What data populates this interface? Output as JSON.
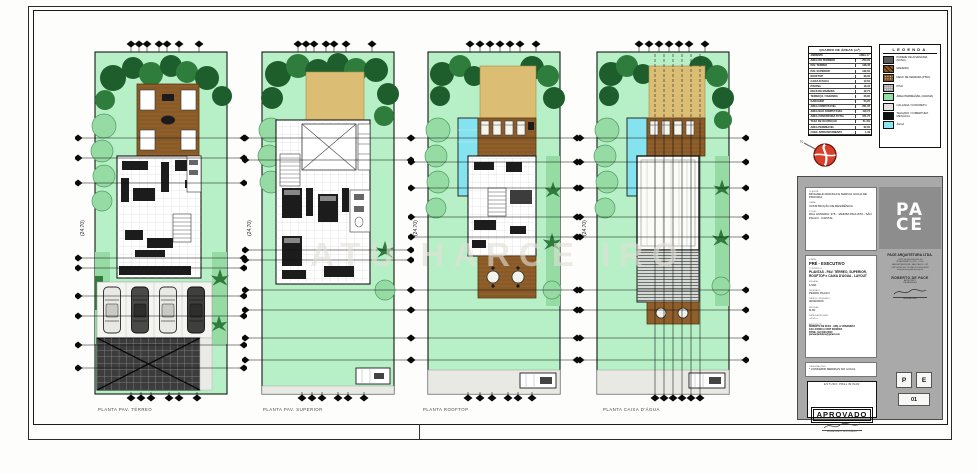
{
  "sheet": {
    "watermark": "ATU HARCE IRO"
  },
  "colors": {
    "grass": "#b7f0c6",
    "tree_dark": "#1d5e2c",
    "tree_mid": "#2f7d3c",
    "deck_wood": "#8f5e2a",
    "sand": "#dcbd74",
    "water": "#84e3ef",
    "asphalt": "#3c3c3c",
    "panel_gray": "#a9a9a9",
    "north_red": "#d8402c"
  },
  "plans": [
    {
      "caption": "PLANTA PAV. TÉRREO",
      "dim_note": "(24.70)"
    },
    {
      "caption": "PLANTA PAV. SUPERIOR",
      "dim_note": "(24.70)"
    },
    {
      "caption": "PLANTA ROOFTOP",
      "dim_note": "(24.70)"
    },
    {
      "caption": "PLANTA CAIXA D'ÁGUA",
      "dim_note": "(24.70)"
    }
  ],
  "areas_table": {
    "title": "QUADRO DE ÁREAS (m²)",
    "col_label": "AMBIENTE",
    "col_value": "ÁREA m²",
    "rows": [
      {
        "label": "ÁREA DO TERRENO",
        "value": "250,00"
      },
      {
        "label": "PAV. TÉRREO",
        "value": "128,45"
      },
      {
        "label": "PAV. SUPERIOR",
        "value": "132,60"
      },
      {
        "label": "ROOFTOP",
        "value": "98,30"
      },
      {
        "label": "CAIXA D'ÁGUA",
        "value": "12,50"
      },
      {
        "label": "PISCINA",
        "value": "18,40"
      },
      {
        "label": "DECK DE MADEIRA",
        "value": "42,75"
      },
      {
        "label": "TERRAÇO / VARANDA",
        "value": "26,80"
      },
      {
        "label": "GARAGEM",
        "value": "54,20"
      },
      {
        "label": "ÁREA COMPUTÁVEL",
        "value": "261,05"
      },
      {
        "label": "ÁREA NÃO COMPUTÁVEL",
        "value": "110,70"
      },
      {
        "label": "ÁREA CONSTRUÍDA TOTAL",
        "value": "371,75"
      },
      {
        "label": "TAXA DE OCUPAÇÃO",
        "value": "51,4%"
      },
      {
        "label": "ÁREA PERMEÁVEL",
        "value": "62,30"
      },
      {
        "label": "COEF. APROVEITAMENTO",
        "value": "1,49"
      }
    ]
  },
  "legend": {
    "title": "LEGENDA",
    "items": [
      {
        "label": "PAREDE DE ALVENARIA (NOVA)",
        "color": "#5a5a5a"
      },
      {
        "label": "MADEIRA",
        "color": "#8a5a2b",
        "pattern": "diag"
      },
      {
        "label": "DECK DE MADEIRA (PISO)",
        "color": "#7a4e20",
        "pattern": "dots"
      },
      {
        "label": "PISO",
        "color": "#cfcfcf",
        "pattern": "tex"
      },
      {
        "label": "ÁREA PERMEÁVEL (GRAMA)",
        "color": "#90e2a6"
      },
      {
        "label": "CALÇADA / CONCRETO",
        "color": "#e2e2de"
      },
      {
        "label": "TELHADO / COBERTURA METÁLICA",
        "color": "#111111"
      },
      {
        "label": "ÁGUA",
        "color": "#8ce4f0"
      }
    ]
  },
  "north": {
    "label": "N"
  },
  "titleblock": {
    "client_label": "CLIENTE:",
    "client": "MICHAELE FRANCHI E MARCIA GIULIA DE PROCIDA",
    "work_label": "OBRA:",
    "work": "CONSTRUÇÃO DE RESIDÊNCIA",
    "site_label": "LOCAL:",
    "site": "RUA HUNGRIA, 976 - JARDIM PAULISTA - SÃO PAULO - CAPITAL",
    "stage_label": "ETAPA:",
    "stage": "PRÉ - EXECUTIVO",
    "content_label": "CONTEÚDO:",
    "content": "PLANTAS - PAV. TÉRREO, SUPERIOR, ROOFTOP e CAIXA D'ÁGUA - LAYOUT",
    "scale_label": "ESCALA:",
    "scale": "1/100",
    "drawing_label": "DESENHO:",
    "drawing": "PEDRO PAULO",
    "date_label": "DATA DO DESENHO:",
    "date": "00/00/0000",
    "rev_label": "REVISÃO:",
    "rev": "R-00",
    "revdate_label": "DATA DA REVISÃO:",
    "revdate": "--/--/----",
    "arch_label": "ARQUITETO:",
    "arch_lines": [
      "ROBERTO DE PACE - ARQ. E URBANISTA",
      "CAU A00000-0 / RRT 00000000",
      "FONE: (11) 0000-0000",
      "pacearquitetura@gmail.com"
    ],
    "obs_label": "OBSERVAÇÕES:",
    "obs": "* CONFERIR MEDIDAS NO LOCAL",
    "stamp_top": "ESTUDO PRELIMINAR",
    "stamp_main": "APROVADO",
    "stamp_sign": "ASSINATURA DO RESPONSÁVEL",
    "logo_line1": "PA",
    "logo_line2": "CE",
    "firm_name": "PACE ARQUITETURA LTDA.",
    "firm_lines": [
      "CNPJ 00.000.000/0001-00",
      "RUA EXEMPLO, 000 - CJ 00",
      "JARDIM PAULISTA - SÃO PAULO - SP",
      "CEP 00000-000 / FONE (11) 0000-0000",
      "www.pacearquitetura.com.br"
    ],
    "architect_name": "ROBERTO DE PACE",
    "architect_role": "ARQUITETO",
    "architect_reg": "CAU A00000-0",
    "sign_caption": "ASSINATURA",
    "code_p": "P",
    "code_e": "E",
    "code_num": "01"
  }
}
